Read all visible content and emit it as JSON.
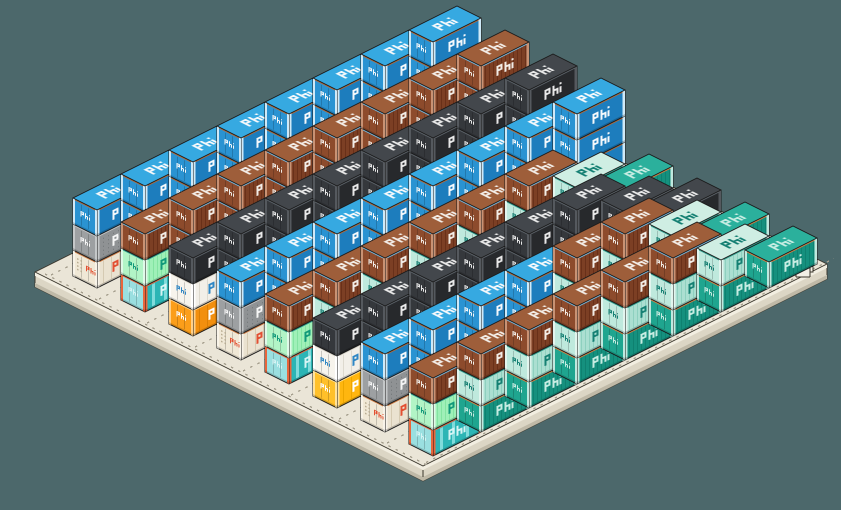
{
  "scene": {
    "description": "isometric pixel-art container terminal barge stacked with phi-branded shipping containers",
    "width": 841,
    "height": 510,
    "background": "#4c686b"
  },
  "brand": {
    "logo_text": "phi",
    "logo_style": "pixel-bars"
  },
  "projection": {
    "origin": [
      73,
      276
    ],
    "length_vec": [
      48,
      -24
    ],
    "width_vec": [
      24,
      12
    ],
    "row_pitch": [
      48,
      24
    ],
    "unit_height": 26
  },
  "palette": {
    "blue": {
      "top": "#36a9e1",
      "side": "#1d7dbd",
      "end": "#2a93d2",
      "post": "#cfe9f7",
      "accent": "#b06a3a",
      "logo": "#f4f8fb",
      "stripe": "#1a6fa8",
      "stripes": "none"
    },
    "brown": {
      "top": "#9e5e3a",
      "side": "#7c3f24",
      "end": "#8d4b2c",
      "post": "#c89274",
      "accent": "#79b8dd",
      "logo": "#f2ece6",
      "stripe": "#693019",
      "stripes": "dense"
    },
    "black": {
      "top": "#43474c",
      "side": "#27292c",
      "end": "#35383c",
      "post": "#55595e",
      "accent": "#5c636a",
      "logo": "#e8e8e8",
      "stripe": "#1f2124",
      "stripes": "none"
    },
    "teal": {
      "top": "#2bb09c",
      "side": "#15907e",
      "end": "#1fa58f",
      "post": "#bfe8de",
      "accent": "#d8803f",
      "logo": "#c6ece2",
      "stripe": "#0e8170",
      "stripes": "dense"
    },
    "mintstr": {
      "top": "#cfeee3",
      "side": "#abdfd1",
      "end": "#bfe9dd",
      "post": "#e2f5ee",
      "accent": "#2f9d8c",
      "logo": "#158073",
      "stripe": "#8ed0bf",
      "stripes": "dense"
    },
    "mint": {
      "top": "#c4f7d4",
      "side": "#9ff0b8",
      "end": "#b2f4c6",
      "post": "#dffae8",
      "accent": "#2f9d8c",
      "logo": "#11997a",
      "stripe": "#83e4a2",
      "stripes": "dense"
    },
    "cyan": {
      "top": "#a8e9e6",
      "side": "#2cb5b5",
      "end": "#9adfe0",
      "post": "#e8663c",
      "accent": "#e8663c",
      "logo": "#d6f4f4",
      "stripe": "#8fe2e2",
      "stripes": "streaks"
    },
    "beige": {
      "top": "#f6f0e2",
      "side": "#eae2d0",
      "end": "#f0e8d6",
      "post": "#f8f3e8",
      "accent": "#c8743c",
      "logo": "#e25032",
      "stripe": "#d5cab2",
      "stripes": "seams"
    },
    "gray": {
      "top": "#abaeb0",
      "side": "#8f9294",
      "end": "#9da0a2",
      "post": "#c4c7c8",
      "accent": "#c4c7c8",
      "logo": "#f5f5f5",
      "stripe": "#707476",
      "stripes": "dots"
    },
    "white": {
      "top": "#fcfaf4",
      "side": "#f2efe8",
      "end": "#f7f4ed",
      "post": "#ffffff",
      "accent": "#d9d5ca",
      "logo": "#2f87c5",
      "stripe": "#ddd9ce",
      "stripes": "seams"
    },
    "orange": {
      "top": "#ffa92c",
      "side": "#f28f0e",
      "end": "#fb9e1a",
      "post": "#ffd089",
      "accent": "#ffd089",
      "logo": "#fdfdfd",
      "stripe": "#db7f05",
      "stripes": "seams"
    },
    "yellow": {
      "top": "#ffca41",
      "side": "#ffb60f",
      "end": "#ffc02a",
      "post": "#ffe29b",
      "accent": "#ffe29b",
      "logo": "#fdfdfd",
      "stripe": "#eda600",
      "stripes": "seams"
    }
  },
  "platform": {
    "corners": {
      "west": [
        35,
        272
      ],
      "north": [
        439,
        70
      ],
      "east": [
        827,
        264
      ],
      "south": [
        423,
        466
      ]
    },
    "thickness": 15,
    "colors": {
      "top": "#eae5d7",
      "edge_step": "#f2eee1",
      "skirt": "#dcd6c5",
      "skirt_dark": "#bfb9a7",
      "outline": "#3a362c",
      "dash": "#a59f8e"
    },
    "cleat": {
      "x": 796,
      "y": 258,
      "color": "#f2efe5"
    },
    "dash_v_offsets": [
      -12,
      36,
      84,
      132,
      180,
      228,
      276,
      324,
      363
    ],
    "dash_u_offset": -12
  },
  "grid": {
    "rows": [
      {
        "name": "row-1",
        "stacks": [
          [
            "beige",
            "gray",
            "blue"
          ],
          [
            "blue",
            "blue",
            "blue"
          ],
          [
            "blue",
            "blue",
            "blue"
          ],
          [
            "blue",
            "blue",
            "blue"
          ],
          [
            "blue",
            "blue",
            "blue"
          ],
          [
            "blue",
            "blue",
            "blue"
          ],
          [
            "blue",
            "blue",
            "blue"
          ],
          [
            "blue",
            "blue",
            "blue"
          ]
        ]
      },
      {
        "name": "row-2",
        "stacks": [
          [
            "cyan",
            "mint",
            "brown"
          ],
          [
            "brown",
            "brown",
            "brown"
          ],
          [
            "brown",
            "brown",
            "brown"
          ],
          [
            "brown",
            "brown",
            "brown"
          ],
          [
            "brown",
            "brown",
            "brown"
          ],
          [
            "brown",
            "brown",
            "brown"
          ],
          [
            "brown",
            "brown",
            "brown"
          ],
          [
            "brown",
            "brown",
            "brown"
          ]
        ]
      },
      {
        "name": "row-3",
        "stacks": [
          [
            "orange",
            "white",
            "black"
          ],
          [
            "black",
            "black",
            "black"
          ],
          [
            "black",
            "black",
            "black"
          ],
          [
            "black",
            "black",
            "black"
          ],
          [
            "black",
            "black",
            "black"
          ],
          [
            "black",
            "black",
            "black"
          ],
          [
            "black",
            "black",
            "black"
          ],
          [
            "black",
            "black",
            "black"
          ]
        ]
      },
      {
        "name": "row-4",
        "stacks": [
          [
            "beige",
            "gray",
            "blue"
          ],
          [
            "blue",
            "blue",
            "blue"
          ],
          [
            "blue",
            "blue",
            "blue"
          ],
          [
            "blue",
            "blue",
            "blue"
          ],
          [
            "blue",
            "blue",
            "blue"
          ],
          [
            "blue",
            "blue",
            "blue"
          ],
          [
            "blue",
            "blue",
            "blue"
          ],
          [
            "blue",
            "blue",
            "blue"
          ]
        ]
      },
      {
        "name": "row-5",
        "stacks": [
          [
            "cyan",
            "mint",
            "brown"
          ],
          [
            "teal",
            "mintstr",
            "brown"
          ],
          [
            "teal",
            "mintstr",
            "brown"
          ],
          [
            "teal",
            "mintstr",
            "brown"
          ],
          [
            "teal",
            "mintstr",
            "brown"
          ],
          [
            "teal",
            "mintstr",
            "brown"
          ],
          [
            "teal",
            "mintstr"
          ],
          [
            "teal"
          ]
        ]
      },
      {
        "name": "row-6",
        "stacks": [
          [
            "yellow",
            "white",
            "black"
          ],
          [
            "black",
            "black",
            "black"
          ],
          [
            "black",
            "black",
            "black"
          ],
          [
            "black",
            "black",
            "black"
          ],
          [
            "black",
            "black",
            "black"
          ],
          [
            "black",
            "black",
            "black"
          ],
          [
            "black",
            "black"
          ],
          [
            "black"
          ]
        ]
      },
      {
        "name": "row-7",
        "stacks": [
          [
            "beige",
            "gray",
            "blue"
          ],
          [
            "blue",
            "blue",
            "blue"
          ],
          [
            "blue",
            "blue",
            "blue"
          ],
          [
            "blue",
            "blue",
            "blue"
          ],
          [
            "teal",
            "mintstr",
            "brown"
          ],
          [
            "teal",
            "mintstr",
            "brown"
          ],
          [
            "teal",
            "mintstr"
          ],
          [
            "teal"
          ]
        ]
      },
      {
        "name": "row-8",
        "stacks": [
          [
            "cyan",
            "mint",
            "brown"
          ],
          [
            "teal",
            "mintstr",
            "brown"
          ],
          [
            "teal",
            "mintstr",
            "brown"
          ],
          [
            "teal",
            "mintstr",
            "brown"
          ],
          [
            "teal",
            "mintstr",
            "brown"
          ],
          [
            "teal",
            "mintstr",
            "brown"
          ],
          [
            "teal",
            "mintstr"
          ],
          [
            "teal"
          ]
        ]
      }
    ]
  }
}
